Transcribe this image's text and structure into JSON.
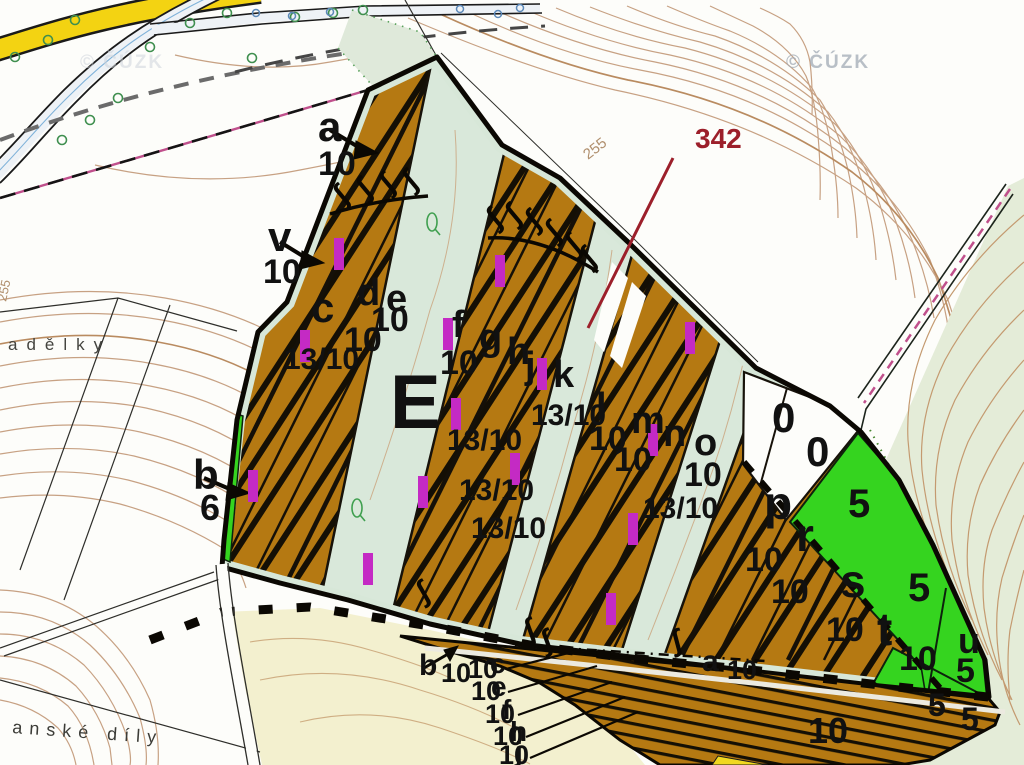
{
  "watermarks": [
    {
      "text": "© ČÚZK"
    },
    {
      "text": "© ČÚZK"
    }
  ],
  "colors": {
    "stand_brown": "#b57912",
    "hatch_black": "#140f05",
    "pale_green_band": "#d9e8da",
    "bright_green": "#35d41f",
    "hillside_green": "#e4ecd8",
    "pale_yellow": "#f3f0cf",
    "magenta_mark": "#c42ac4",
    "contour_tan": "#c7a183",
    "motorway_yellow": "#f3d312",
    "annotation_red": "#9c1f2a",
    "boundary_pink": "#c0508c",
    "label_black": "#111111"
  },
  "map_labels": [
    {
      "t": "a",
      "x": 318,
      "y": 141,
      "s": 42
    },
    {
      "t": "10",
      "x": 318,
      "y": 175,
      "s": 34
    },
    {
      "t": "v",
      "x": 268,
      "y": 251,
      "s": 42
    },
    {
      "t": "10",
      "x": 263,
      "y": 283,
      "s": 34
    },
    {
      "t": "b",
      "x": 193,
      "y": 489,
      "s": 42
    },
    {
      "t": "6",
      "x": 200,
      "y": 520,
      "s": 36
    },
    {
      "t": "c",
      "x": 311,
      "y": 322,
      "s": 42
    },
    {
      "t": "d",
      "x": 357,
      "y": 305,
      "s": 38
    },
    {
      "t": "e",
      "x": 386,
      "y": 311,
      "s": 38
    },
    {
      "t": "10",
      "x": 371,
      "y": 331,
      "s": 34
    },
    {
      "t": "10",
      "x": 344,
      "y": 351,
      "s": 34
    },
    {
      "t": "13/10",
      "x": 284,
      "y": 369,
      "s": 30
    },
    {
      "t": "E",
      "x": 390,
      "y": 428,
      "s": 76
    },
    {
      "t": "f",
      "x": 452,
      "y": 337,
      "s": 38
    },
    {
      "t": "10",
      "x": 440,
      "y": 374,
      "s": 34
    },
    {
      "t": "g",
      "x": 479,
      "y": 350,
      "s": 38
    },
    {
      "t": "h",
      "x": 507,
      "y": 364,
      "s": 38
    },
    {
      "t": "j",
      "x": 525,
      "y": 378,
      "s": 38
    },
    {
      "t": "k",
      "x": 553,
      "y": 387,
      "s": 38
    },
    {
      "t": "13/10",
      "x": 447,
      "y": 450,
      "s": 30
    },
    {
      "t": "13/10",
      "x": 531,
      "y": 425,
      "s": 30
    },
    {
      "t": "13/10",
      "x": 459,
      "y": 500,
      "s": 30
    },
    {
      "t": "13/10",
      "x": 471,
      "y": 538,
      "s": 30
    },
    {
      "t": "13/10",
      "x": 643,
      "y": 518,
      "s": 30
    },
    {
      "t": "l",
      "x": 596,
      "y": 419,
      "s": 38
    },
    {
      "t": "10",
      "x": 589,
      "y": 450,
      "s": 34
    },
    {
      "t": "m",
      "x": 631,
      "y": 433,
      "s": 38
    },
    {
      "t": "10",
      "x": 614,
      "y": 471,
      "s": 34
    },
    {
      "t": "n",
      "x": 663,
      "y": 446,
      "s": 38
    },
    {
      "t": "o",
      "x": 694,
      "y": 455,
      "s": 38
    },
    {
      "t": "10",
      "x": 684,
      "y": 486,
      "s": 34
    },
    {
      "t": "0",
      "x": 772,
      "y": 432,
      "s": 42
    },
    {
      "t": "0",
      "x": 806,
      "y": 466,
      "s": 42
    },
    {
      "t": "p",
      "x": 764,
      "y": 519,
      "s": 46
    },
    {
      "t": "10",
      "x": 745,
      "y": 571,
      "s": 34
    },
    {
      "t": "r",
      "x": 796,
      "y": 551,
      "s": 46
    },
    {
      "t": "10",
      "x": 771,
      "y": 603,
      "s": 34
    },
    {
      "t": "s",
      "x": 840,
      "y": 597,
      "s": 46
    },
    {
      "t": "10",
      "x": 826,
      "y": 641,
      "s": 34
    },
    {
      "t": "t",
      "x": 877,
      "y": 645,
      "s": 46
    },
    {
      "t": "10",
      "x": 899,
      "y": 670,
      "s": 34
    },
    {
      "t": "u",
      "x": 958,
      "y": 653,
      "s": 36
    },
    {
      "t": "5",
      "x": 848,
      "y": 517,
      "s": 40
    },
    {
      "t": "5",
      "x": 908,
      "y": 601,
      "s": 40
    },
    {
      "t": "5",
      "x": 956,
      "y": 682,
      "s": 34
    },
    {
      "t": "5",
      "x": 928,
      "y": 716,
      "s": 32
    },
    {
      "t": "5",
      "x": 961,
      "y": 730,
      "s": 32
    },
    {
      "t": "a",
      "x": 702,
      "y": 671,
      "s": 30
    },
    {
      "t": "10",
      "x": 727,
      "y": 679,
      "s": 27
    },
    {
      "t": "10",
      "x": 808,
      "y": 743,
      "s": 36
    },
    {
      "t": "b",
      "x": 419,
      "y": 675,
      "s": 30
    },
    {
      "t": "10",
      "x": 441,
      "y": 682,
      "s": 27
    },
    {
      "t": "10",
      "x": 468,
      "y": 678,
      "s": 27
    },
    {
      "t": "c",
      "x": 490,
      "y": 673,
      "s": 28
    },
    {
      "t": "10",
      "x": 471,
      "y": 700,
      "s": 27
    },
    {
      "t": "e",
      "x": 491,
      "y": 696,
      "s": 28
    },
    {
      "t": "10",
      "x": 485,
      "y": 723,
      "s": 27
    },
    {
      "t": "f",
      "x": 502,
      "y": 719,
      "s": 28
    },
    {
      "t": "10",
      "x": 493,
      "y": 745,
      "s": 27
    },
    {
      "t": "h",
      "x": 510,
      "y": 741,
      "s": 28
    },
    {
      "t": "10",
      "x": 499,
      "y": 764,
      "s": 27
    },
    {
      "t": "j",
      "x": 515,
      "y": 761,
      "s": 28
    },
    {
      "t": "342",
      "x": 695,
      "y": 148,
      "s": 28,
      "w": 700,
      "c": "#9c1f2a"
    },
    {
      "t": "255",
      "x": 588,
      "y": 160,
      "s": 15,
      "w": 400,
      "c": "#b08f6d",
      "r": -38
    },
    {
      "t": "255",
      "x": 6,
      "y": 302,
      "s": 13,
      "w": 400,
      "c": "#b08f6d",
      "r": -78
    },
    {
      "t": "adělky",
      "x": 8,
      "y": 350,
      "s": 17,
      "w": 400,
      "c": "#44443f",
      "sp": 9
    },
    {
      "t": "anské díly",
      "x": 12,
      "y": 733,
      "s": 18,
      "w": 400,
      "c": "#3c3c37",
      "sp": 7,
      "r": 4
    }
  ],
  "magenta_marks": [
    [
      334,
      238
    ],
    [
      495,
      255
    ],
    [
      300,
      330
    ],
    [
      443,
      318
    ],
    [
      537,
      358
    ],
    [
      685,
      322
    ],
    [
      451,
      398
    ],
    [
      510,
      453
    ],
    [
      418,
      476
    ],
    [
      248,
      470
    ],
    [
      648,
      424
    ],
    [
      628,
      513
    ],
    [
      363,
      553
    ],
    [
      606,
      593
    ]
  ],
  "hook_symbols": {
    "glyph": "∫",
    "positions": [
      [
        344,
        205,
        -40
      ],
      [
        367,
        198,
        -40
      ],
      [
        390,
        193,
        -40
      ],
      [
        413,
        190,
        -40
      ],
      [
        497,
        228,
        -40
      ],
      [
        516,
        224,
        -40
      ],
      [
        536,
        230,
        -40
      ],
      [
        556,
        241,
        -40
      ],
      [
        576,
        254,
        -40
      ],
      [
        591,
        267,
        -40
      ],
      [
        424,
        602,
        -30
      ],
      [
        529,
        640,
        -20
      ],
      [
        546,
        651,
        -20
      ],
      [
        675,
        651,
        -15
      ]
    ]
  },
  "tree_symbols": {
    "green": [
      [
        75,
        20
      ],
      [
        48,
        40
      ],
      [
        15,
        57
      ],
      [
        118,
        98
      ],
      [
        90,
        120
      ],
      [
        62,
        140
      ],
      [
        150,
        47
      ],
      [
        190,
        23
      ],
      [
        227,
        13
      ],
      [
        252,
        58
      ],
      [
        295,
        17
      ],
      [
        333,
        13
      ],
      [
        363,
        10
      ]
    ],
    "blue": [
      [
        256,
        13
      ],
      [
        292,
        16
      ],
      [
        330,
        12
      ],
      [
        460,
        9
      ],
      [
        498,
        14
      ],
      [
        520,
        8
      ]
    ]
  },
  "q_symbols": [
    [
      432,
      222
    ],
    [
      357,
      508
    ]
  ]
}
